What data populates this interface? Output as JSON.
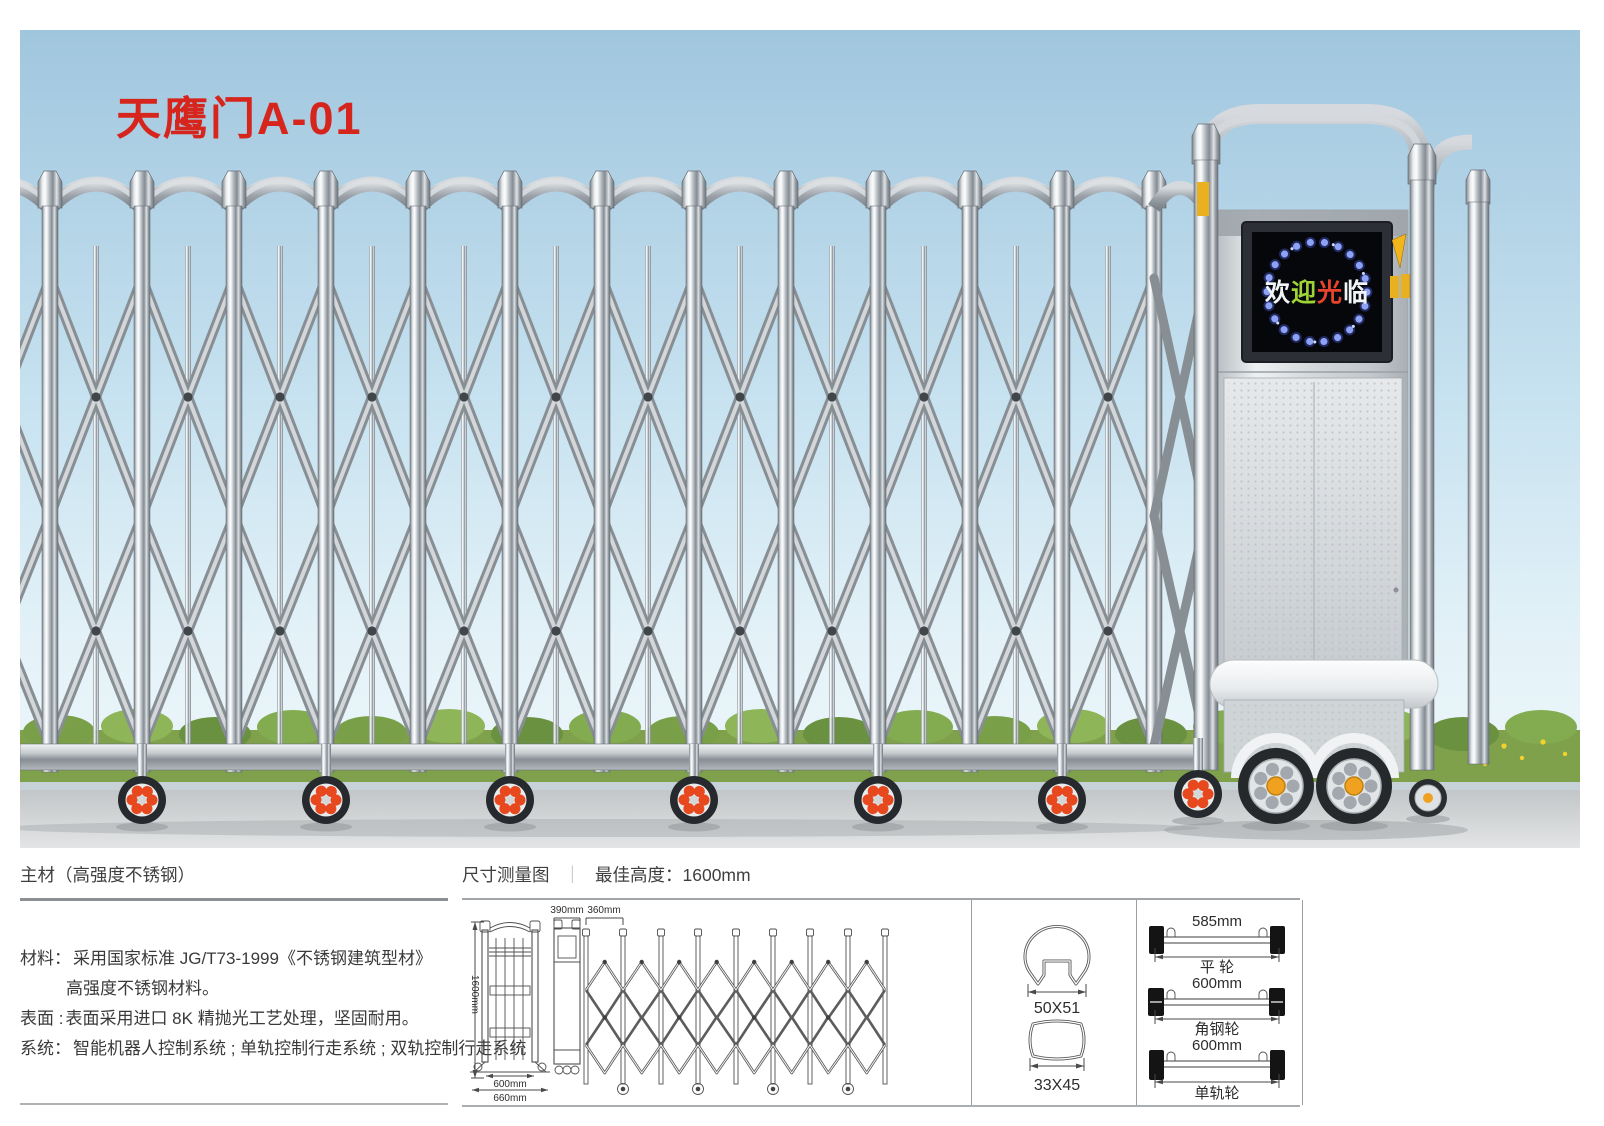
{
  "title": {
    "text": "天鹰门A-01",
    "color": "#d6251d"
  },
  "photo": {
    "led": {
      "chars": [
        {
          "ch": "欢",
          "color": "#f2f5f8"
        },
        {
          "ch": "迎",
          "color": "#9ed435"
        },
        {
          "ch": "光",
          "color": "#e8432e"
        },
        {
          "ch": "临",
          "color": "#f2f5f8"
        }
      ]
    }
  },
  "specs": {
    "header": "主材（高强度不锈钢）",
    "rows": [
      {
        "label": "材料：",
        "text": "采用国家标准 JG/T73-1999《不锈钢建筑型材》"
      },
      {
        "label": "",
        "text": "高强度不锈钢材料。"
      },
      {
        "label": "表面 :",
        "text": "表面采用进口 8K 精抛光工艺处理，坚固耐用。"
      },
      {
        "label": "系统：",
        "text": "智能机器人控制系统 ; 单轨控制行走系统 ; 双轨控制行走系统"
      }
    ]
  },
  "dims": {
    "header": "尺寸测量图",
    "divider": "｜",
    "best_height": "最佳高度：1600mm",
    "gate": {
      "height": "1600mm",
      "inner_width": "600mm",
      "outer_width": "660mm",
      "post_depth": "390mm",
      "unit_width": "360mm"
    },
    "profiles": [
      {
        "label": "50X51"
      },
      {
        "label": "33X45"
      }
    ],
    "wheels": [
      {
        "size": "585mm",
        "name": "平 轮"
      },
      {
        "size": "600mm",
        "name": "角钢轮"
      },
      {
        "size": "600mm",
        "name": "单轨轮"
      }
    ]
  }
}
